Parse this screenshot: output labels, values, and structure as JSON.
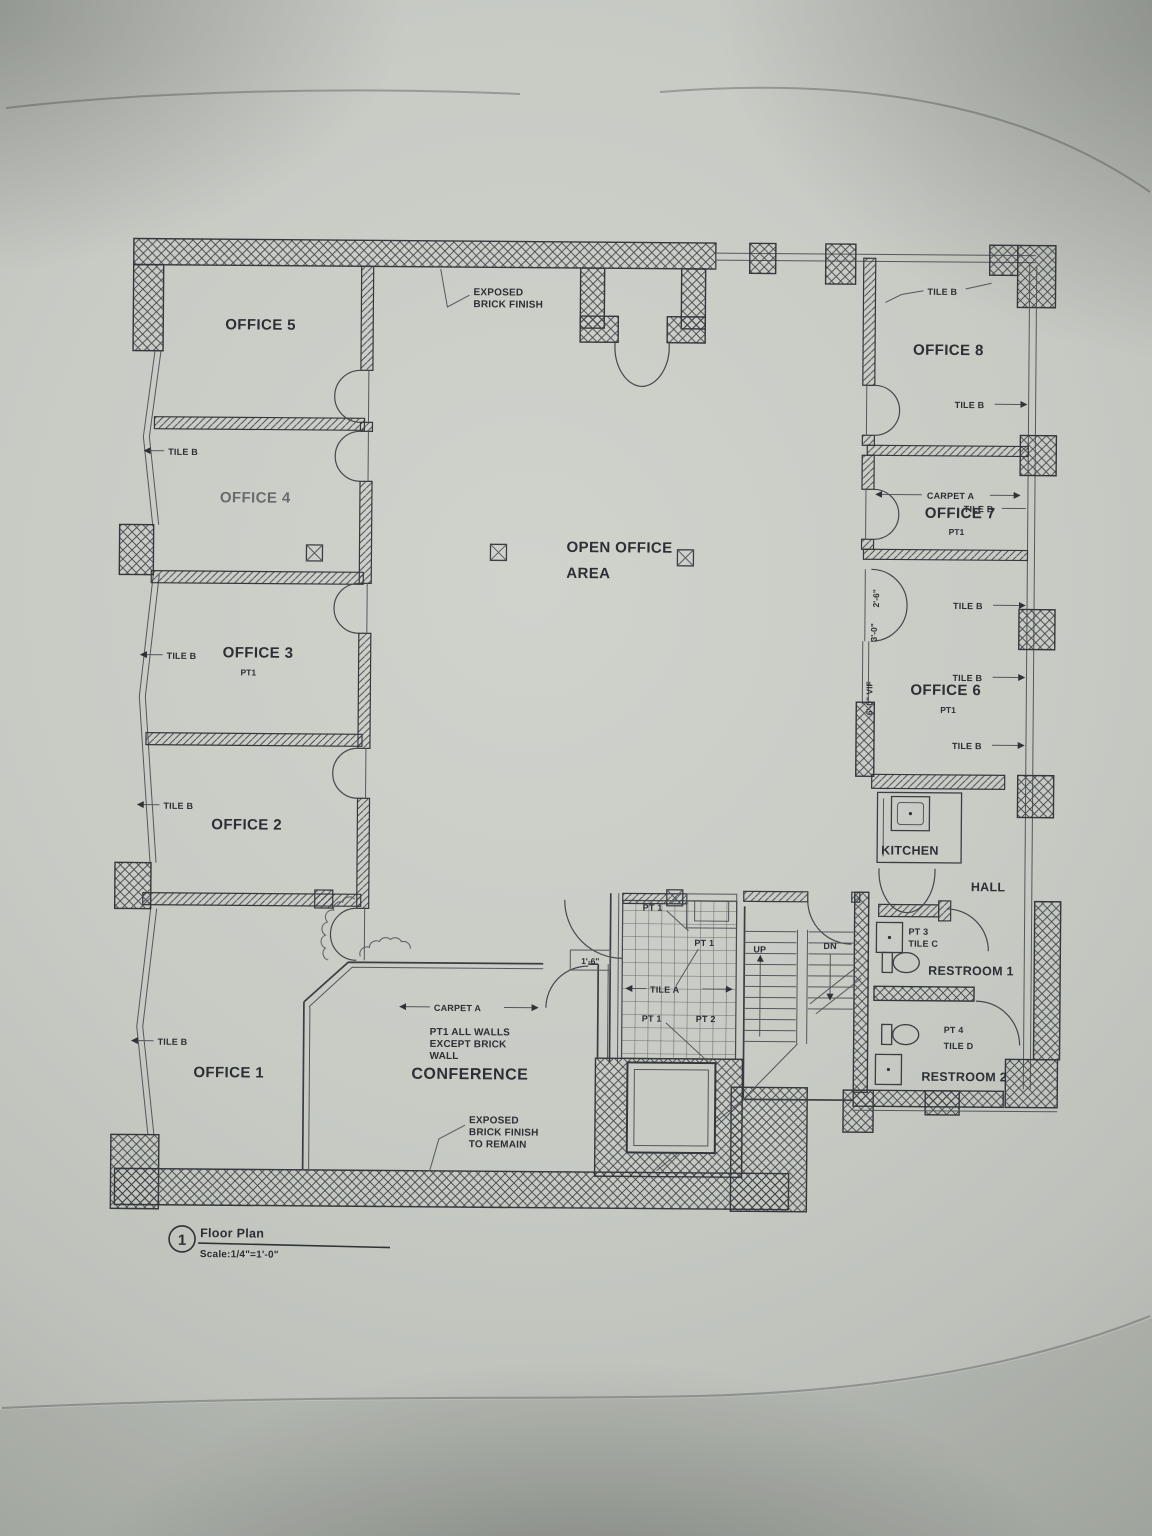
{
  "photo": {
    "paper_color": "#c7cbc4",
    "ink_color": "#2c2f35",
    "description": "photographed architectural floor plan sheet"
  },
  "drawing": {
    "detail_number": "1",
    "title": "Floor Plan",
    "scale": "Scale:1/4\"=1'-0\"",
    "rooms": {
      "office1": "OFFICE 1",
      "office2": "OFFICE 2",
      "office3": "OFFICE 3",
      "office4": "OFFICE 4",
      "office5": "OFFICE 5",
      "office6": "OFFICE 6",
      "office7": "OFFICE 7",
      "office8": "OFFICE 8",
      "conference": "CONFERENCE",
      "open_office_line1": "OPEN OFFICE",
      "open_office_line2": "AREA",
      "kitchen": "KITCHEN",
      "hall": "HALL",
      "restroom1": "RESTROOM 1",
      "restroom2": "RESTROOM 2"
    },
    "finishes": {
      "tile_a": "TILE A",
      "tile_b": "TILE B",
      "tile_c": "TILE C",
      "tile_d": "TILE D",
      "carpet_a": "CARPET A",
      "pt1": "PT1",
      "pt_1": "PT 1",
      "pt_2": "PT 2",
      "pt_3": "PT 3",
      "pt_4": "PT 4"
    },
    "notes": {
      "exposed_brick": [
        "EXPOSED",
        "BRICK FINISH"
      ],
      "exposed_brick_remain": [
        "EXPOSED",
        "BRICK FINISH",
        "TO REMAIN"
      ],
      "conference_finish": [
        "PT1 ALL WALLS",
        "EXCEPT BRICK",
        "WALL"
      ]
    },
    "stairs": {
      "up": "UP",
      "down": "DN"
    },
    "dimensions": {
      "door_a": "2'-6\"",
      "door_b": "3'-0\"",
      "opening_vif": "6'-0\" VIF",
      "lobby": "1'-6\""
    }
  }
}
